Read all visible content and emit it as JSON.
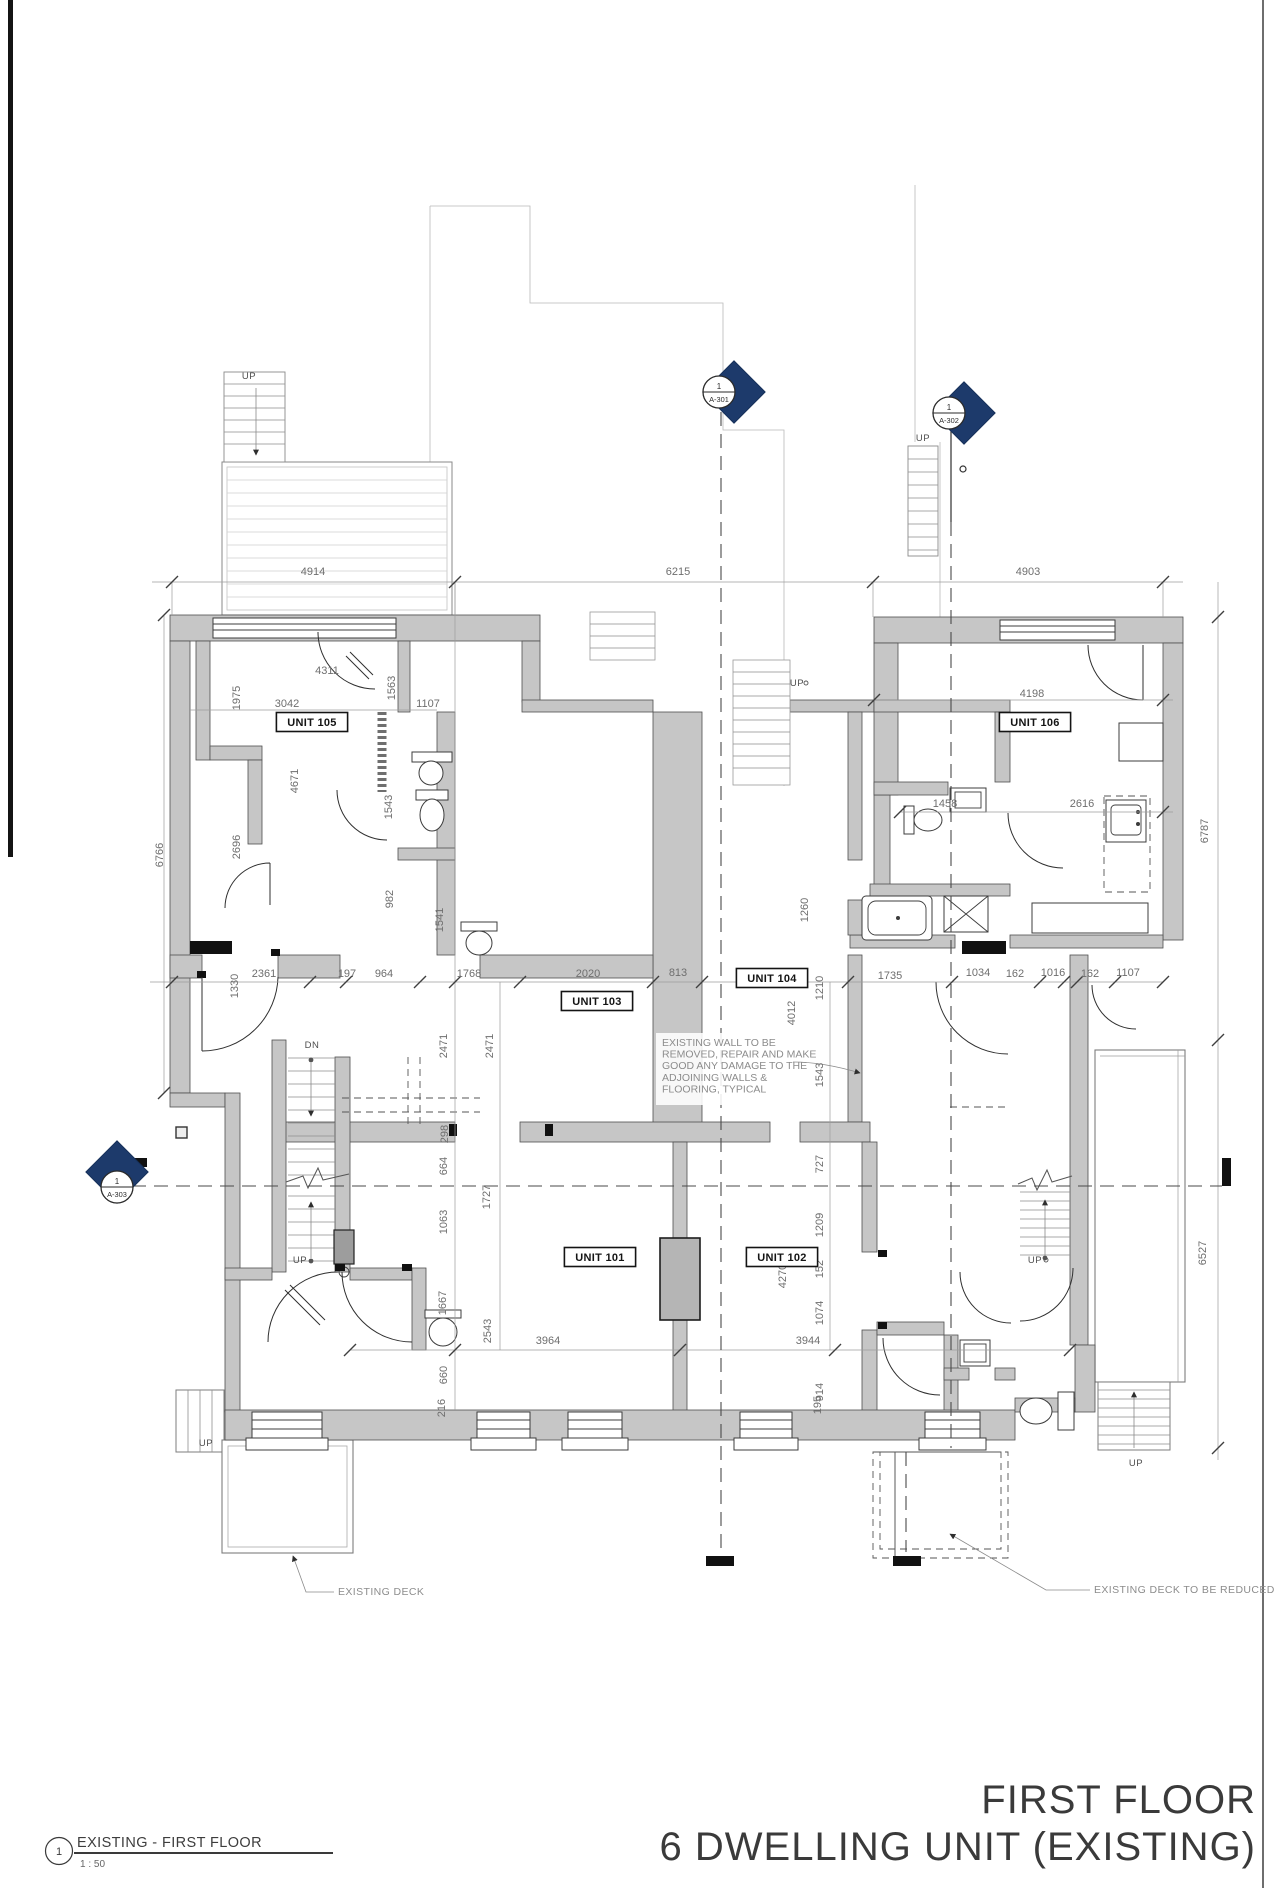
{
  "sheet": {
    "title_line1": "FIRST FLOOR",
    "title_line2": "6 DWELLING UNIT (EXISTING)"
  },
  "viewport": {
    "number": "1",
    "name": "EXISTING - FIRST FLOOR",
    "scale": "1 : 50"
  },
  "callouts": {
    "deck_left": "EXISTING DECK",
    "deck_right": "EXISTING DECK TO BE REDUCED"
  },
  "note": {
    "lines": [
      "EXISTING WALL TO BE",
      "REMOVED, REPAIR AND MAKE",
      "GOOD ANY DAMAGE TO THE",
      "ADJOINING WALLS &",
      "FLOORING, TYPICAL"
    ]
  },
  "sections": [
    {
      "num": "1",
      "sheet": "A-301"
    },
    {
      "num": "1",
      "sheet": "A-302"
    },
    {
      "num": "1",
      "sheet": "A-303"
    }
  ],
  "units": [
    {
      "label": "UNIT 101",
      "x": 600,
      "y": 1257
    },
    {
      "label": "UNIT 102",
      "x": 782,
      "y": 1257
    },
    {
      "label": "UNIT 103",
      "x": 597,
      "y": 1001
    },
    {
      "label": "UNIT 104",
      "x": 772,
      "y": 978
    },
    {
      "label": "UNIT 105",
      "x": 312,
      "y": 722
    },
    {
      "label": "UNIT 106",
      "x": 1035,
      "y": 722
    }
  ],
  "colors": {
    "wall_gray": "#c6c6c6",
    "marker_blue": "#1d3a6b",
    "text_gray": "#6e6e6e"
  },
  "annotations": [
    {
      "t": "4914",
      "x": 313,
      "y": 575
    },
    {
      "t": "6215",
      "x": 678,
      "y": 575
    },
    {
      "t": "4903",
      "x": 1028,
      "y": 575
    },
    {
      "t": "4311",
      "x": 327,
      "y": 674
    },
    {
      "t": "3042",
      "x": 287,
      "y": 707
    },
    {
      "t": "1107",
      "x": 428,
      "y": 707
    },
    {
      "t": "1563",
      "x": 395,
      "y": 688,
      "r": 1
    },
    {
      "t": "1975",
      "x": 240,
      "y": 698,
      "r": 1
    },
    {
      "t": "4671",
      "x": 298,
      "y": 781,
      "r": 1
    },
    {
      "t": "2696",
      "x": 240,
      "y": 847,
      "r": 1
    },
    {
      "t": "1543",
      "x": 392,
      "y": 807,
      "r": 1
    },
    {
      "t": "982",
      "x": 393,
      "y": 899,
      "r": 1
    },
    {
      "t": "1541",
      "x": 443,
      "y": 920,
      "r": 1
    },
    {
      "t": "6766",
      "x": 163,
      "y": 855,
      "r": 1
    },
    {
      "t": "1330",
      "x": 238,
      "y": 986,
      "r": 1
    },
    {
      "t": "2361",
      "x": 264,
      "y": 977
    },
    {
      "t": "197",
      "x": 347,
      "y": 977
    },
    {
      "t": "964",
      "x": 384,
      "y": 977
    },
    {
      "t": "1768",
      "x": 469,
      "y": 977
    },
    {
      "t": "2020",
      "x": 588,
      "y": 977
    },
    {
      "t": "813",
      "x": 678,
      "y": 976
    },
    {
      "t": "1735",
      "x": 890,
      "y": 979
    },
    {
      "t": "1034",
      "x": 978,
      "y": 976
    },
    {
      "t": "162",
      "x": 1015,
      "y": 977
    },
    {
      "t": "1016",
      "x": 1053,
      "y": 976
    },
    {
      "t": "162",
      "x": 1090,
      "y": 977
    },
    {
      "t": "1107",
      "x": 1128,
      "y": 976
    },
    {
      "t": "4198",
      "x": 1032,
      "y": 697
    },
    {
      "t": "1458",
      "x": 945,
      "y": 807
    },
    {
      "t": "2616",
      "x": 1082,
      "y": 807
    },
    {
      "t": "6787",
      "x": 1208,
      "y": 831,
      "r": 1
    },
    {
      "t": "2471",
      "x": 447,
      "y": 1046,
      "r": 1
    },
    {
      "t": "2471",
      "x": 493,
      "y": 1046,
      "r": 1
    },
    {
      "t": "298",
      "x": 448,
      "y": 1134,
      "r": 1
    },
    {
      "t": "664",
      "x": 447,
      "y": 1166,
      "r": 1
    },
    {
      "t": "1063",
      "x": 447,
      "y": 1222,
      "r": 1
    },
    {
      "t": "1727",
      "x": 490,
      "y": 1197,
      "r": 1
    },
    {
      "t": "1667",
      "x": 446,
      "y": 1303,
      "r": 1
    },
    {
      "t": "2543",
      "x": 491,
      "y": 1331,
      "r": 1
    },
    {
      "t": "660",
      "x": 447,
      "y": 1375,
      "r": 1
    },
    {
      "t": "216",
      "x": 445,
      "y": 1408,
      "r": 1
    },
    {
      "t": "1260",
      "x": 808,
      "y": 910,
      "r": 1
    },
    {
      "t": "1210",
      "x": 823,
      "y": 988,
      "r": 1
    },
    {
      "t": "4012",
      "x": 795,
      "y": 1013,
      "r": 1
    },
    {
      "t": "1543",
      "x": 823,
      "y": 1075,
      "r": 1
    },
    {
      "t": "727",
      "x": 823,
      "y": 1164,
      "r": 1
    },
    {
      "t": "1209",
      "x": 823,
      "y": 1225,
      "r": 1
    },
    {
      "t": "152",
      "x": 823,
      "y": 1269,
      "r": 1
    },
    {
      "t": "4270",
      "x": 786,
      "y": 1276,
      "r": 1
    },
    {
      "t": "1074",
      "x": 823,
      "y": 1313,
      "r": 1
    },
    {
      "t": "914",
      "x": 823,
      "y": 1392,
      "r": 1
    },
    {
      "t": "195",
      "x": 821,
      "y": 1405,
      "r": 1
    },
    {
      "t": "3964",
      "x": 548,
      "y": 1344
    },
    {
      "t": "3944",
      "x": 808,
      "y": 1344
    },
    {
      "t": "6527",
      "x": 1206,
      "y": 1253,
      "r": 1
    },
    {
      "t": "UP",
      "x": 249,
      "y": 379,
      "c": "up"
    },
    {
      "t": "UP",
      "x": 923,
      "y": 441,
      "c": "up"
    },
    {
      "t": "UP",
      "x": 797,
      "y": 686,
      "c": "up"
    },
    {
      "t": "DN",
      "x": 312,
      "y": 1048,
      "c": "up"
    },
    {
      "t": "UP",
      "x": 300,
      "y": 1263,
      "c": "up"
    },
    {
      "t": "UP",
      "x": 1035,
      "y": 1263,
      "c": "up"
    },
    {
      "t": "UP",
      "x": 206,
      "y": 1446,
      "c": "up"
    },
    {
      "t": "UP",
      "x": 1136,
      "y": 1466,
      "c": "up"
    }
  ]
}
